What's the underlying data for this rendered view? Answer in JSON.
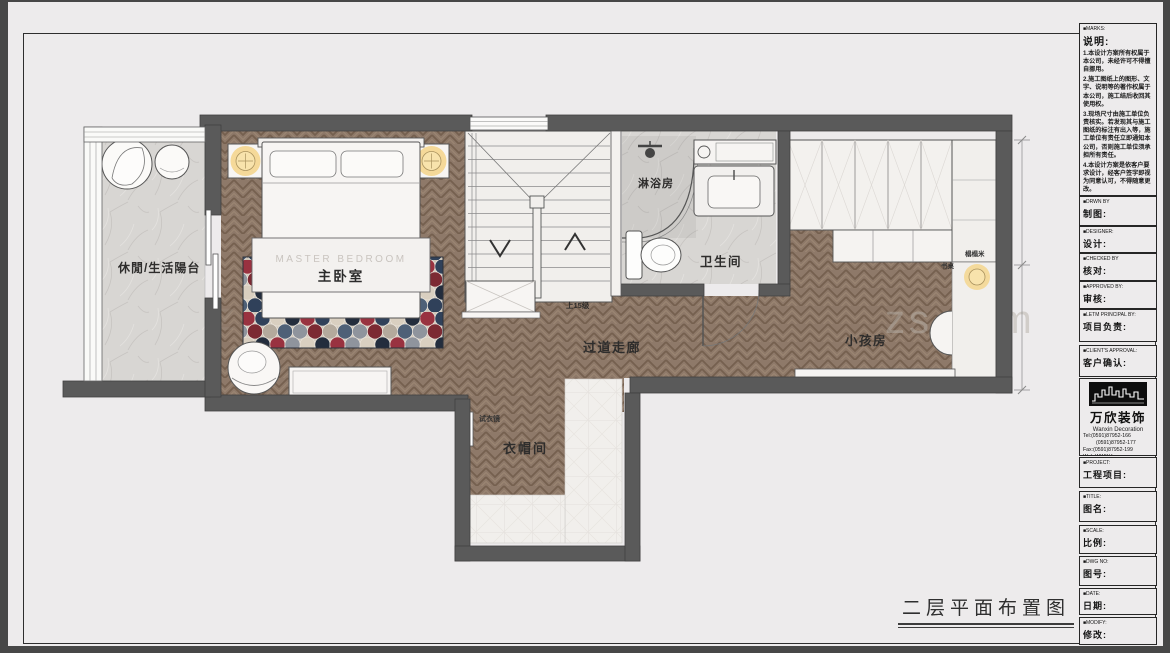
{
  "page": {
    "drawing_label": "二层平面布置图",
    "watermark": "zs.com"
  },
  "plan": {
    "rooms": {
      "balcony": "休閒/生活陽台",
      "master_bedroom_en": "MASTER BEDROOM",
      "master_bedroom": "主卧室",
      "shower": "淋浴房",
      "bathroom": "卫生间",
      "corridor": "过道走廊",
      "kids_room": "小孩房",
      "cloakroom": "衣帽间"
    },
    "annotations": {
      "stairs_note": "上15级",
      "desk": "书桌",
      "tatami": "榻榻米",
      "fitting_mirror": "试衣镜"
    },
    "colors": {
      "wall": "#5a5a5a",
      "wood": "#8e7969",
      "marble": "#d8d6d3",
      "lamp_glow": "#f5d488",
      "rug_red": "#993240",
      "rug_navy": "#30415a"
    }
  },
  "titleblock": {
    "notes": {
      "label_en": "■MARKS:",
      "label_zh": "说明:",
      "items": [
        "1.本设计方案所有权属于本公司，未经许可不得擅自挪用。",
        "2.施工图纸上的图形、文字、说明等的著作权属于本公司，施工结后收回其使用权。",
        "3.现场尺寸由施工单位负责核实。若发现其与施工图纸的标注有出入等，施工单位有责任立即通知本公司，否则施工单位须承担所有责任。",
        "4.本设计方案是依客户要求设计，经客户签字即视为同意认可，不得随意更改。"
      ]
    },
    "fields": [
      {
        "en": "■DRWN BY",
        "zh": "制图:"
      },
      {
        "en": "■DESIGNER:",
        "zh": "设计:"
      },
      {
        "en": "■CHECKED BY",
        "zh": "核对:"
      },
      {
        "en": "■APPROVED BY:",
        "zh": "审核:"
      },
      {
        "en": "■LETM PRINCIPAL BY:",
        "zh": "项目负责:"
      },
      {
        "en": "■CLIENT'S APPROVAL:",
        "zh": "客户确认:"
      },
      {
        "en": "■PROJECT:",
        "zh": "工程项目:"
      },
      {
        "en": "■TITLE:",
        "zh": "图名:"
      },
      {
        "en": "■SCALE:",
        "zh": "比例:"
      },
      {
        "en": "■DWG NO:",
        "zh": "图号:"
      },
      {
        "en": "■DATE:",
        "zh": "日期:"
      },
      {
        "en": "■MODIFY:",
        "zh": "修改:"
      }
    ],
    "logo": {
      "name_zh": "万欣装饰",
      "name_en": "Wanxin Decoration",
      "tel1": "Tel:(0591)87952-166",
      "tel2": "(0591)87952-177",
      "fax": "Fax:(0591)87952-199",
      "web": "Web:WWW.fzwxzs.com"
    }
  }
}
